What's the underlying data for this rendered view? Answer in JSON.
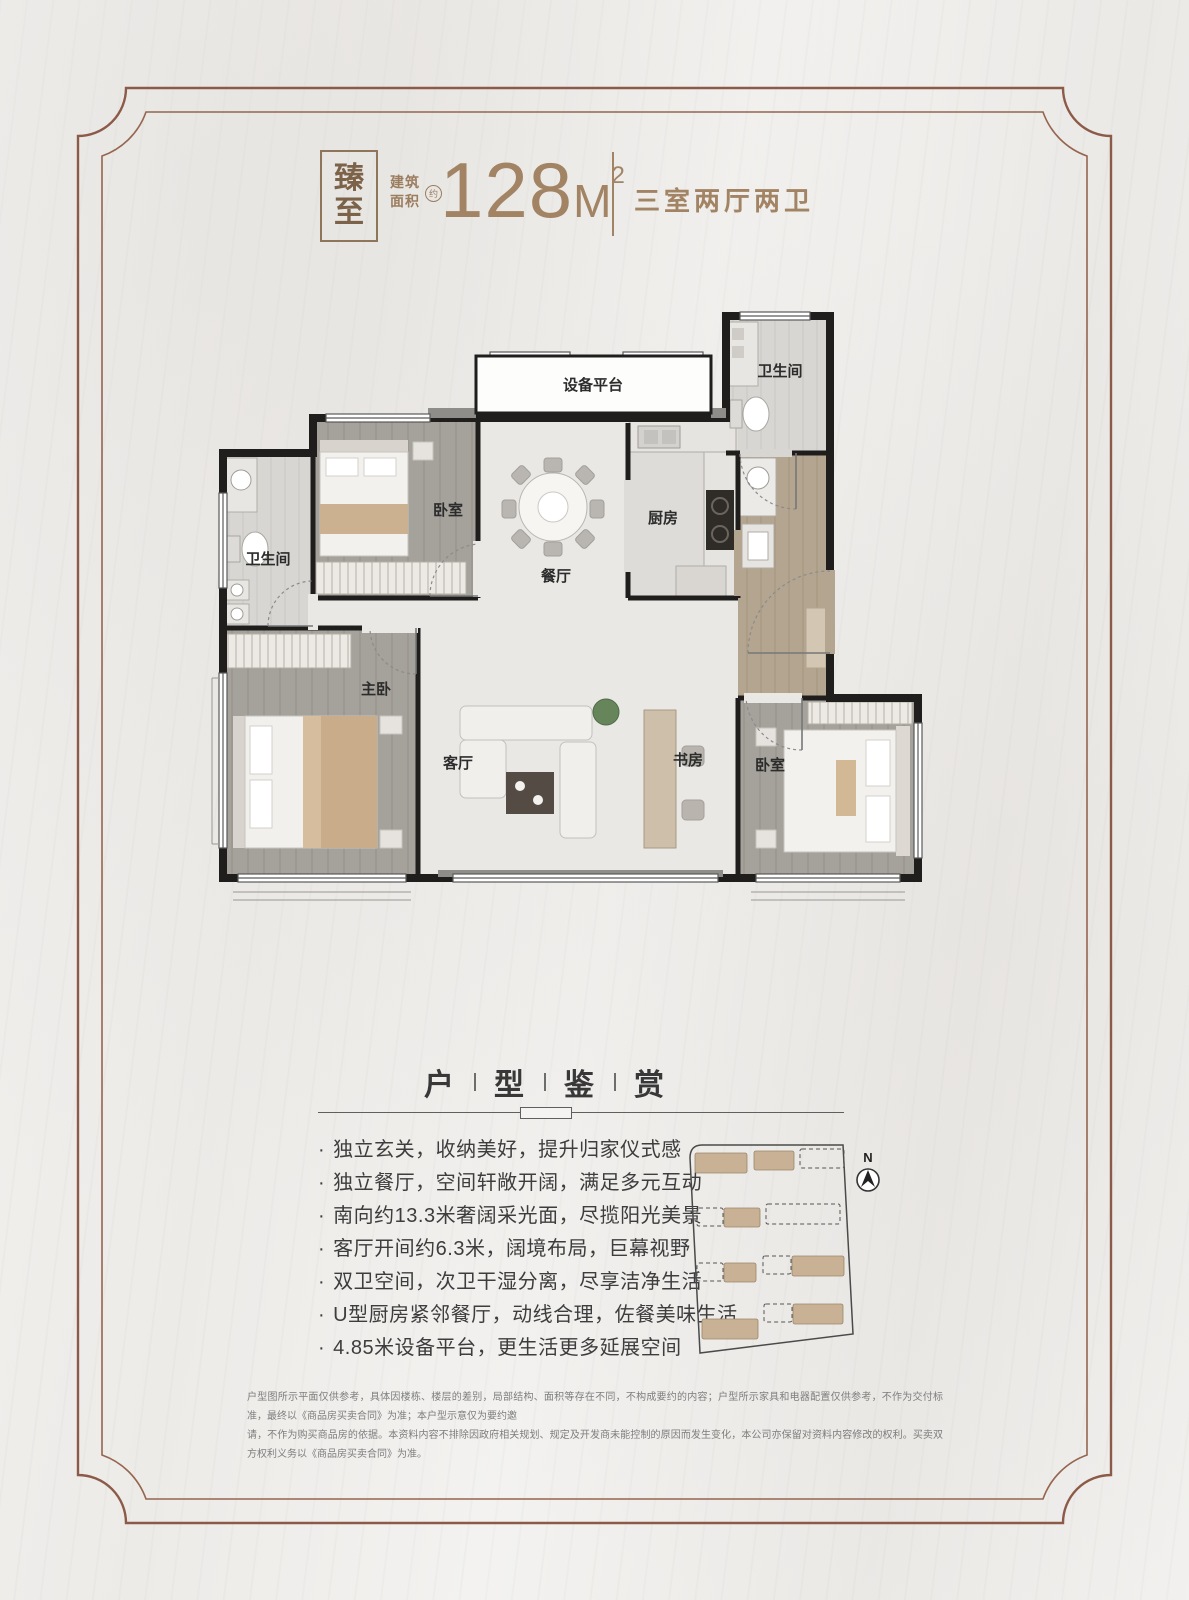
{
  "colors": {
    "accent": "#a28464",
    "brand": "#7c6248",
    "frame": "#8c5a48",
    "wall": "#201e1c",
    "tan_fill": "#c9b196"
  },
  "header": {
    "brand_chars": [
      "臻",
      "至"
    ],
    "area_label_line1": "建筑",
    "area_label_line2": "面积",
    "approx_badge": "约",
    "area_value": "128",
    "area_unit": "M",
    "area_sup": "2",
    "layout_text": "三室两厅两卫"
  },
  "floorplan": {
    "rooms": [
      {
        "id": "equipment-platform",
        "label": "设备平台"
      },
      {
        "id": "bath-top",
        "label": "卫生间"
      },
      {
        "id": "bedroom-top",
        "label": "卧室"
      },
      {
        "id": "dining",
        "label": "餐厅"
      },
      {
        "id": "kitchen",
        "label": "厨房"
      },
      {
        "id": "bath-left",
        "label": "卫生间"
      },
      {
        "id": "master-bedroom",
        "label": "主卧"
      },
      {
        "id": "living",
        "label": "客厅"
      },
      {
        "id": "study",
        "label": "书房"
      },
      {
        "id": "bedroom-right",
        "label": "卧室"
      }
    ]
  },
  "section": {
    "title_chars": [
      "户",
      "型",
      "鉴",
      "赏"
    ],
    "bullet": "·",
    "features": [
      "独立玄关，收纳美好，提升归家仪式感",
      "独立餐厅，空间轩敞开阔，满足多元互动",
      "南向约13.3米奢阔采光面，尽揽阳光美景",
      "客厅开间约6.3米，阔境布局，巨幕视野",
      "双卫空间，次卫干湿分离，尽享洁净生活",
      "U型厨房紧邻餐厅，动线合理，佐餐美味生活",
      "4.85米设备平台，更生活更多延展空间"
    ]
  },
  "minimap": {
    "north_label": "N",
    "blocks": [
      {
        "x": 45,
        "y": 33,
        "w": 52,
        "h": 20,
        "filled": true
      },
      {
        "x": 104,
        "y": 31,
        "w": 40,
        "h": 19,
        "filled": true
      },
      {
        "x": 150,
        "y": 29,
        "w": 44,
        "h": 19,
        "filled": false
      },
      {
        "x": 47,
        "y": 88,
        "w": 26,
        "h": 18,
        "filled": false
      },
      {
        "x": 74,
        "y": 88,
        "w": 36,
        "h": 19,
        "filled": true
      },
      {
        "x": 116,
        "y": 84,
        "w": 74,
        "h": 20,
        "filled": false
      },
      {
        "x": 47,
        "y": 143,
        "w": 26,
        "h": 18,
        "filled": false
      },
      {
        "x": 74,
        "y": 143,
        "w": 32,
        "h": 19,
        "filled": true
      },
      {
        "x": 113,
        "y": 136,
        "w": 28,
        "h": 18,
        "filled": false
      },
      {
        "x": 142,
        "y": 136,
        "w": 52,
        "h": 20,
        "filled": true
      },
      {
        "x": 52,
        "y": 199,
        "w": 56,
        "h": 20,
        "filled": true
      },
      {
        "x": 114,
        "y": 184,
        "w": 28,
        "h": 18,
        "filled": false
      },
      {
        "x": 143,
        "y": 184,
        "w": 50,
        "h": 20,
        "filled": true
      }
    ]
  },
  "disclaimer": {
    "line1": "户型图所示平面仅供参考，具体因楼栋、楼层的差别，局部结构、面积等存在不同，不构成要约的内容；户型所示家具和电器配置仅供参考，不作为交付标准，最终以《商品房买卖合同》为准；本户型示意仅为要约邀",
    "line2": "请，不作为购买商品房的依据。本资料内容不排除因政府相关规划、规定及开发商未能控制的原因而发生变化，本公司亦保留对资料内容修改的权利。买卖双方权利义务以《商品房买卖合同》为准。"
  }
}
